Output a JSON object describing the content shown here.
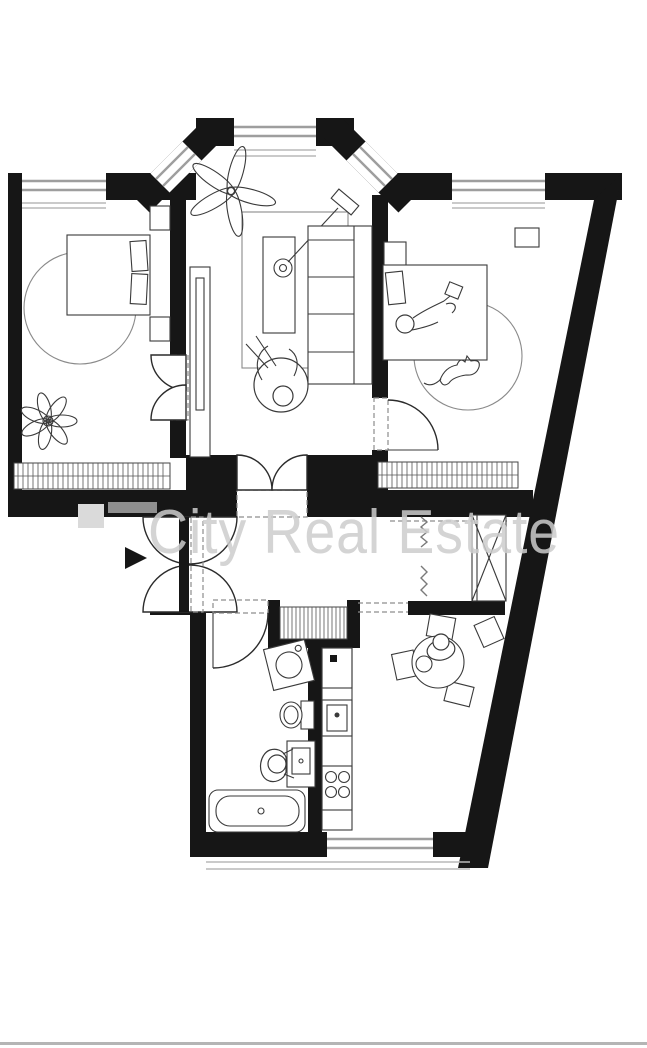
{
  "watermark": {
    "text": "City Real Estate"
  },
  "colors": {
    "walls": "#161616",
    "background": "#ffffff",
    "window_stripe": "#9e9e9e",
    "sill_line": "#b9b9b9",
    "watermark_text": "#cdcdcd",
    "watermark_logo_dark": "#8f8f8f",
    "watermark_logo_light": "#dadada",
    "bottom_bar": "#b5b5b5",
    "furniture_stroke": "#3a3a3a"
  },
  "plan": {
    "type": "apartment-floor-plan",
    "entrance_symbol": "black-arrow-right",
    "window_count": 6,
    "rooms": [
      {
        "id": "bedroom-left",
        "symbols": [
          "double-bed",
          "pillows",
          "nightstand",
          "wardrobe",
          "round-rug",
          "plant",
          "radiator",
          "double-door"
        ]
      },
      {
        "id": "living-room",
        "symbols": [
          "bay-window",
          "plant",
          "wardrobe-shelf",
          "rug",
          "coffee-table",
          "floor-lamp",
          "sofa",
          "person-on-lounge-chair",
          "double-door"
        ]
      },
      {
        "id": "bedroom-right",
        "symbols": [
          "bed-with-person",
          "nightstand",
          "wall-shelf",
          "round-rug",
          "cat",
          "radiator",
          "door"
        ]
      },
      {
        "id": "hallway",
        "symbols": [
          "double-swing-entrance-door",
          "entrance-arrow",
          "ventilation-shaft",
          "heating-riser",
          "wardrobe-dashed"
        ]
      },
      {
        "id": "bathroom",
        "symbols": [
          "washing-machine",
          "toilet",
          "washbasin-with-person",
          "bathtub",
          "door"
        ]
      },
      {
        "id": "kitchen",
        "symbols": [
          "fridge",
          "kitchen-sink",
          "stove-four-burners",
          "counter",
          "radiator-niche"
        ]
      },
      {
        "id": "dining-area",
        "symbols": [
          "round-table",
          "chairs",
          "person-at-table"
        ]
      }
    ]
  }
}
